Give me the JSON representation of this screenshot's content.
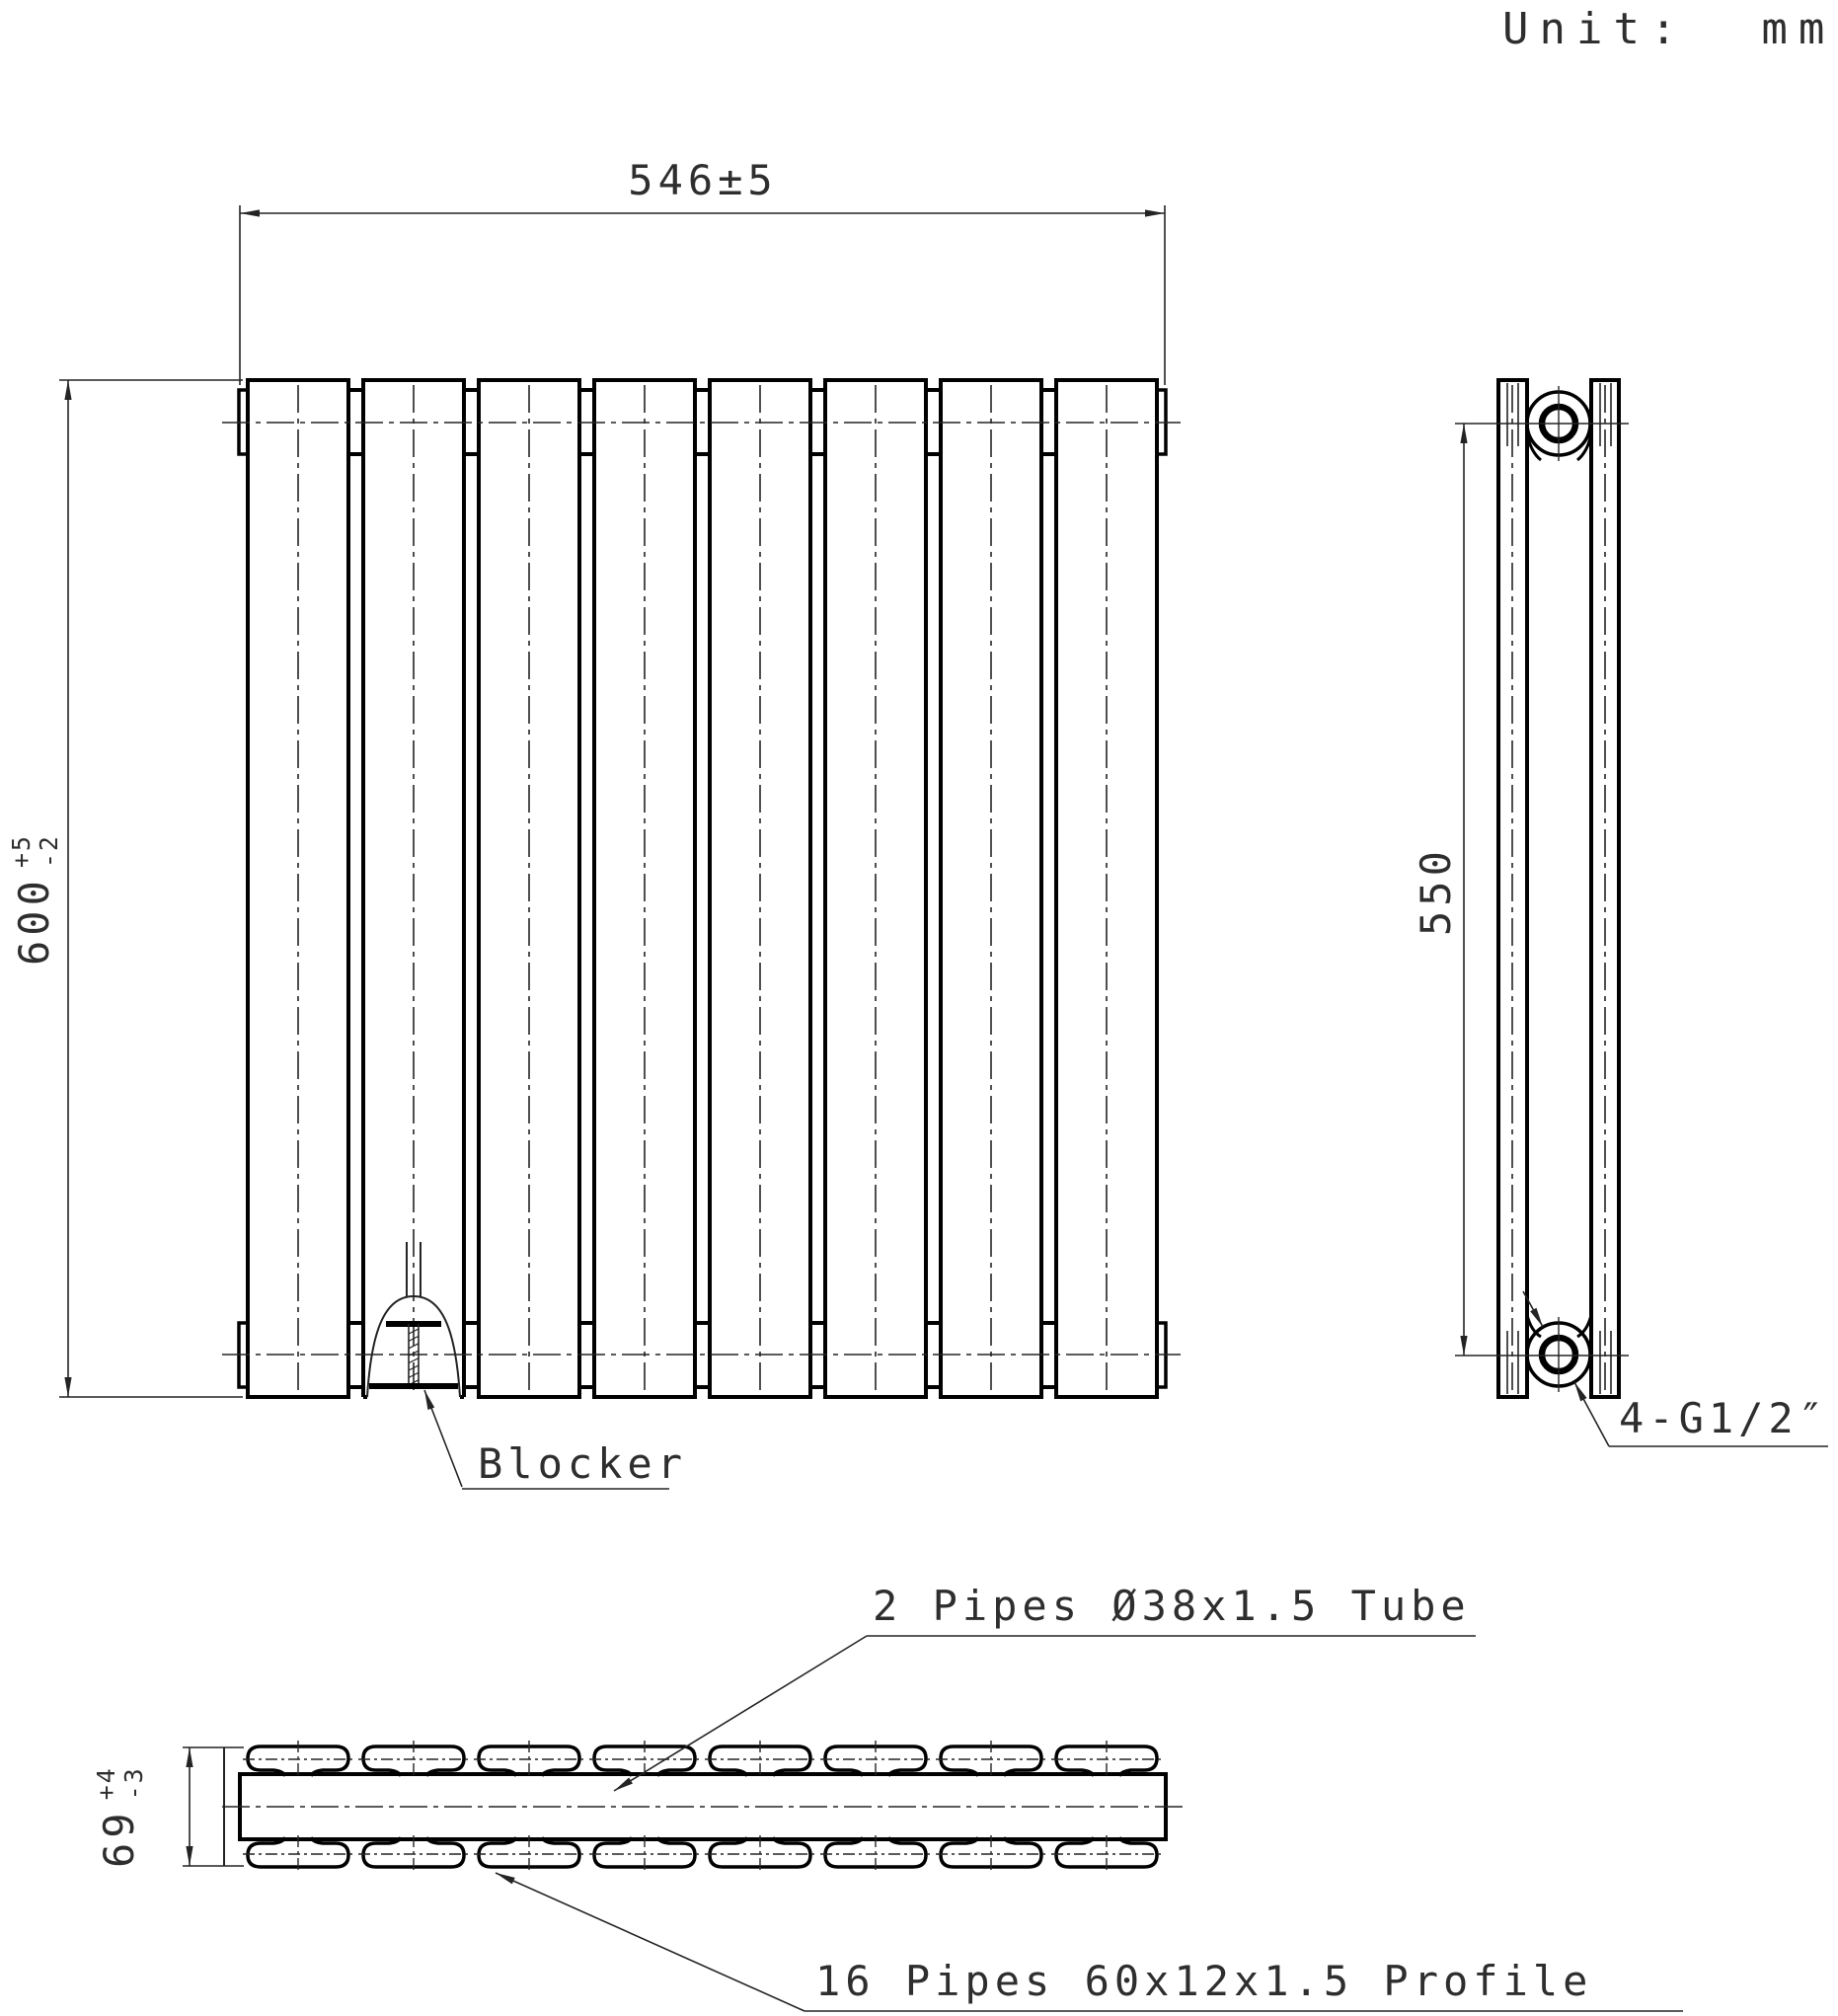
{
  "meta": {
    "unit_note": "Unit:  mm",
    "drawing_type": "radiator technical drawing, front / side / top views"
  },
  "dimensions": {
    "overall_width": {
      "text": "546±5"
    },
    "overall_height": {
      "value": "600",
      "tol_plus": "+5",
      "tol_minus": "-2"
    },
    "port_spacing": {
      "text": "550"
    },
    "depth": {
      "value": "69",
      "tol_plus": "+4",
      "tol_minus": "-3"
    }
  },
  "labels": {
    "blocker": "Blocker",
    "fittings": "4-G1/2″",
    "tube": "2 Pipes Ø38x1.5 Tube",
    "profile": "16 Pipes 60x12x1.5 Profile"
  },
  "structure": {
    "panel_count": 8,
    "gap_count": 7,
    "top_profile_count": 8,
    "bottom_profile_count": 8,
    "fitting_count": 4
  },
  "colors": {
    "line": "#000000",
    "thin_line": "#242424",
    "text": "#2e2e2e",
    "background": "#ffffff"
  }
}
